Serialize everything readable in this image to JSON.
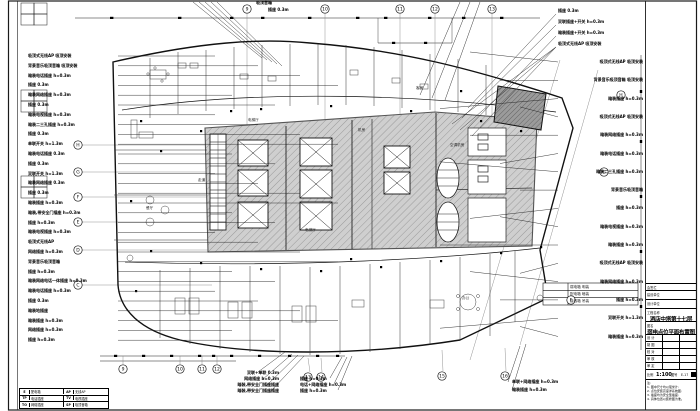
{
  "sheet": {
    "scale": "1:100"
  },
  "annotations": {
    "left": [
      "吸顶式无线AP 吸顶安装",
      "背景音乐吸顶音箱 吸顶安装",
      "暗装电话插座 h=0.3m",
      "插座 0.3m",
      "暗装网络插座 h=0.3m",
      "插座 0.3m",
      "暗装电视插座 h=0.3m",
      "暗装二三孔插座 h=0.3m",
      "插座 0.3m",
      "单联开关 h=1.3m",
      "暗装电话插座 0.3m",
      "插座 0.3m",
      "双联开关 h=1.3m",
      "暗装网络插座 0.3m",
      "插座 0.3m",
      "暗装插座 h=0.3m",
      "暗装,带安全门插座 h=0.3m",
      "插座 h=0.3m",
      "暗装电视插座 h=0.3m",
      "吸顶式无线AP",
      "网络插座 h=0.3m",
      "背景音乐吸顶音箱",
      "插座 h=0.3m",
      "暗装网络电话一体插座 h=0.3m",
      "暗装电话插座 h=0.3m",
      "插座 0.3m",
      "暗装地插座",
      "暗装插座 h=0.3m",
      "网络插座 h=0.3m",
      "插座 h=0.3m"
    ],
    "right": [
      "吸顶式无线AP 吸顶安装",
      "背景音乐吸顶音箱 吸顶安装",
      "暗装插座 h=0.3m",
      "吸顶式无线AP 吸顶安装",
      "暗装网络插座 h=0.3m",
      "暗装电话插座 h=0.3m",
      "暗装二三孔插座 h=0.3m",
      "背景音乐吸顶音箱",
      "插座 h=0.3m",
      "暗装电视插座 h=0.3m",
      "暗装插座 h=0.3m",
      "吸顶式无线AP 吸顶安装",
      "暗装网络插座 h=0.3m",
      "插座 h=0.3m",
      "双联开关 h=1.3m",
      "暗装插座 h=0.3m"
    ],
    "top_right": [
      "插座 0.3m",
      "双联插座+开关 h=0.3m",
      "暗装插座+开关 h=0.3m",
      "吸顶式无线AP 吸顶安装"
    ],
    "top_left": [
      "吸顶音箱",
      "插座 0.3m"
    ],
    "bottom_a": [
      "双联+单联 0.3m",
      "网络插座 h=0.3m",
      "暗装,带安全门插座插座",
      "暗装,带安全门插座插座"
    ],
    "bottom_b": [
      "插座 h=0.3m",
      "电话+网络插座 h=0.3m",
      "插座 h=0.3m"
    ],
    "bottom_c": [
      "单联+网络插座 h=0.3m",
      "暗装插座 h=0.3m"
    ],
    "rooms": [
      "电梯厅",
      "电梯厅",
      "机房",
      "空调机房",
      "走道",
      "办公",
      "餐厅",
      "客房"
    ]
  },
  "grid": {
    "top": [
      "9",
      "10",
      "11",
      "12",
      "13"
    ],
    "bottom1": [
      "9",
      "10",
      "11",
      "12"
    ],
    "bottom2": [
      "13",
      "14",
      "15",
      "16"
    ],
    "left": [
      "H",
      "G",
      "F",
      "E",
      "D",
      "C"
    ],
    "right": [
      "H",
      "G",
      "F"
    ]
  },
  "note_table": [
    "弱电箱 明装",
    "配电箱 暗装",
    "接线箱 吊装"
  ],
  "legend": {
    "rows": [
      {
        "s1": "E",
        "n1": "配电箱",
        "s2": "AP",
        "n2": "无线AP"
      },
      {
        "s1": "TP",
        "n1": "电话插座",
        "s2": "TV",
        "n2": "电视插座"
      },
      {
        "s1": "TO",
        "n1": "网络插座",
        "s2": "SP",
        "n2": "吸顶音箱"
      }
    ]
  },
  "titleblock": {
    "sign_label": "会签栏",
    "owner_label": "建设单位",
    "designer_label": "设计单位",
    "project_label": "工程名称",
    "project_name": "酒店中塔第十七层",
    "drawing_label": "图名",
    "drawing_name": "弱电点位平面布置图",
    "sig_rows": [
      "设 计",
      "制 图",
      "校 对",
      "审 核",
      "审 定"
    ],
    "scale_label": "比例",
    "scale_value": "1:100",
    "number_label": "图号",
    "number_value": "E-17",
    "notes": [
      "注:",
      "1. 图中尺寸均以毫米计;",
      "2. 点位安装高度详系统图;",
      "3. 插座均为安全型插座;",
      "4. 具体位置以装修图为准。"
    ]
  },
  "colors": {
    "line": "#1a1a1a",
    "core_fill": "#cfcfcf",
    "core_hatch": "#9a9a9a",
    "dark_room": "#9b9b9b"
  }
}
